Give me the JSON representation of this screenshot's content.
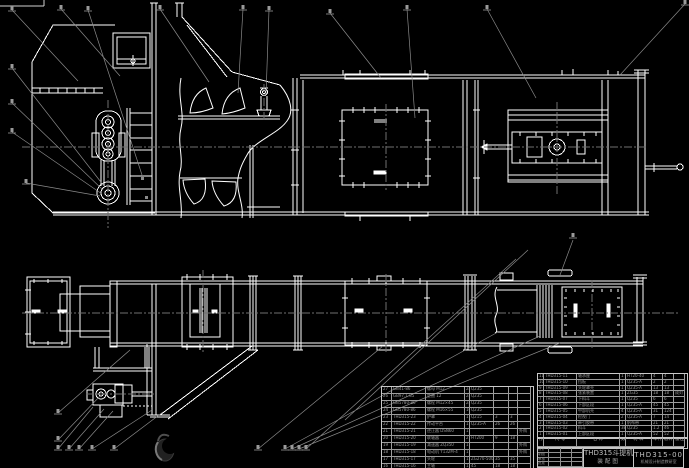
{
  "colors": {
    "background": "#000000",
    "primary_line": "#ffffff",
    "secondary_line": "#8a8a8a",
    "table_text": "#9a9a9a"
  },
  "title_block": {
    "product_title": "THD315斗提机",
    "drawing_type": "装配图",
    "drawing_no": "THD315-00",
    "org": "机械设计制造教研室",
    "sign_labels": [
      "设计",
      "制图",
      "审核",
      "批准"
    ]
  },
  "bom_right": {
    "header": [
      "序号",
      "代 号",
      "名 称",
      "数量",
      "材 料",
      "单件",
      "总计",
      "备注"
    ],
    "rows": [
      [
        "11",
        "THD315-11",
        "轴承座",
        "1",
        "HT20-40",
        "4",
        "4",
        ""
      ],
      [
        "10",
        "THD315-10",
        "挡板",
        "1",
        "Q235-A",
        "2",
        "2",
        ""
      ],
      [
        "9",
        "THD315-09",
        "头轮罩壳",
        "1",
        "Q235-A",
        "13",
        "13",
        ""
      ],
      [
        "8",
        "THD315-08",
        "张紧装置",
        "1",
        "ZG35",
        "18",
        "18",
        "成对"
      ],
      [
        "7",
        "THD315-07",
        "下料斗",
        "1",
        "Q235",
        "6",
        "6",
        ""
      ],
      [
        "6",
        "THD315-06",
        "下部区段",
        "1",
        "Q235-A",
        "45",
        "45",
        ""
      ],
      [
        "5",
        "THD315-05",
        "中部机壳",
        "4",
        "Q235-A",
        "31",
        "124",
        ""
      ],
      [
        "4",
        "THD315-04",
        "检视门",
        "2",
        "Q235-A",
        "7",
        "14",
        ""
      ],
      [
        "3",
        "THD315-03",
        "牵引胶带",
        "1",
        "帆布带",
        "21",
        "21",
        ""
      ],
      [
        "2",
        "THD315-02",
        "料斗",
        "38",
        "Q235",
        "1.2",
        "46",
        ""
      ],
      [
        "1",
        "THD315-01",
        "上部区段",
        "1",
        "Q235-A",
        "52",
        "52",
        ""
      ]
    ]
  },
  "bom_left": {
    "rows": [
      [
        "27",
        "GB41-86",
        "螺母 M12",
        "24",
        "Q235",
        "",
        "",
        ""
      ],
      [
        "26",
        "GB97.1-85",
        "垫圈 12",
        "24",
        "Q235",
        "",
        "",
        ""
      ],
      [
        "25",
        "GB5780-86",
        "螺栓 M12×45",
        "24",
        "Q235",
        "",
        "",
        ""
      ],
      [
        "24",
        "GB5780-86",
        "螺栓 M16×55",
        "16",
        "Q235",
        "",
        "",
        ""
      ],
      [
        "23",
        "THD315-23",
        "护罩",
        "1",
        "Q215",
        "3",
        "3",
        ""
      ],
      [
        "22",
        "THD315-22",
        "传动平台",
        "1",
        "Q235-A",
        "26",
        "26",
        ""
      ],
      [
        "21",
        "THD315-21",
        "逆止器 DSN60",
        "1",
        "",
        "",
        "",
        "外购"
      ],
      [
        "20",
        "THD315-20",
        "联轴器",
        "2",
        "HT200",
        "9",
        "18",
        ""
      ],
      [
        "19",
        "THD315-19",
        "减速器 ZQ350",
        "1",
        "",
        "",
        "",
        "外购"
      ],
      [
        "18",
        "THD315-18",
        "电动机 Y132M-4",
        "1",
        "",
        "",
        "",
        "外购"
      ],
      [
        "17",
        "THD315-17",
        "头轮",
        "1",
        "ZG270-500",
        "35",
        "35",
        ""
      ],
      [
        "16",
        "THD315-16",
        "主轴",
        "1",
        "45",
        "18",
        "18",
        ""
      ]
    ]
  }
}
